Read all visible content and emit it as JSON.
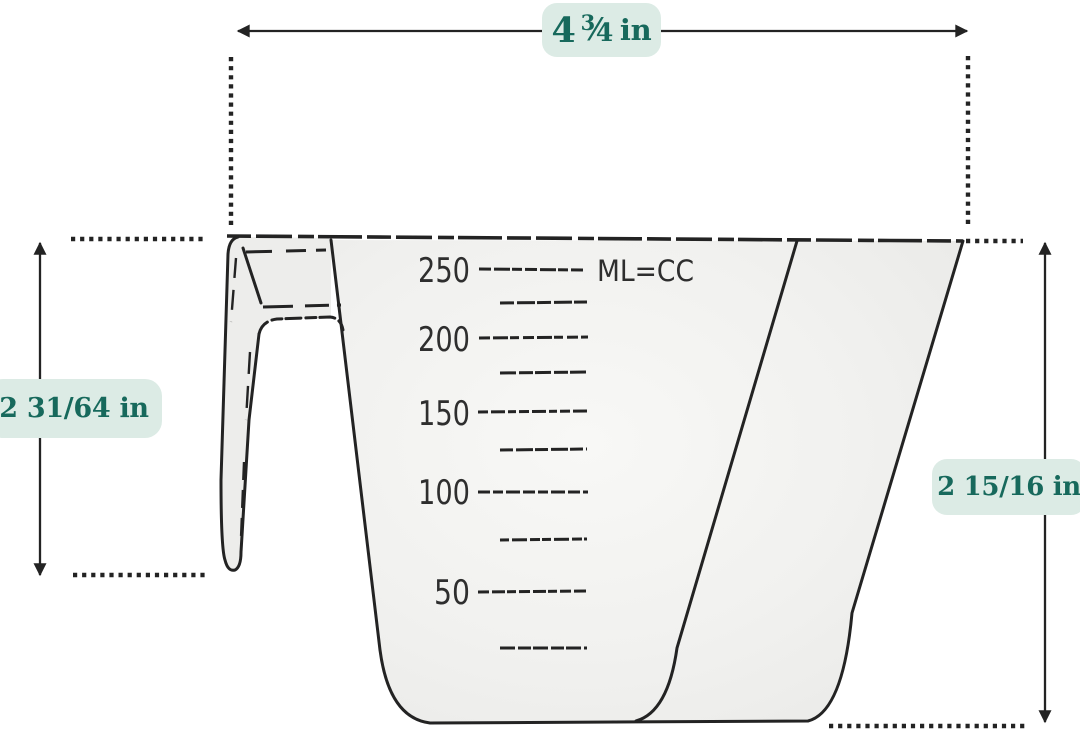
{
  "figure": {
    "type": "product-dimension-diagram",
    "subject": "measuring cup line drawing with dimensions"
  },
  "annotations": {
    "top": {
      "whole": "4",
      "numerator": "3",
      "slash": "⁄",
      "denominator": "4",
      "unit": "in"
    },
    "left": {
      "value": "2 31/64 in"
    },
    "right": {
      "value": "2 15/16 in"
    }
  },
  "cup": {
    "unit_label": "ML=CC",
    "scale": [
      "250",
      "200",
      "150",
      "100",
      "50"
    ]
  },
  "theme": {
    "badge_bg": "#dcebe5",
    "badge_text": "#17695c",
    "ink": "#232323",
    "cup_fill": "#e9e9e7",
    "handle_fill": "#ededeb",
    "page_bg": "#ffffff"
  }
}
